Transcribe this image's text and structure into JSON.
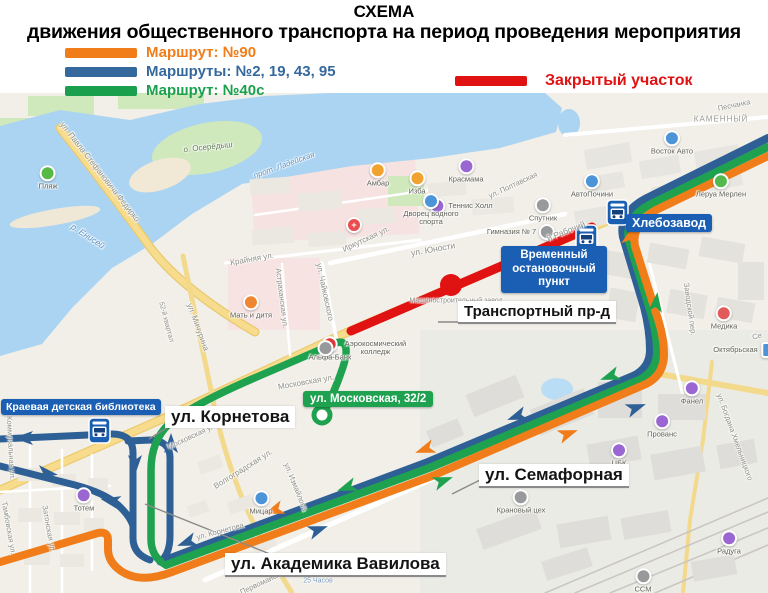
{
  "header": {
    "title": "СХЕМА",
    "subtitle": "движения общественного транспорта на период проведения мероприятия"
  },
  "legend": {
    "routes": [
      {
        "label": "Маршрут: №90",
        "color": "#f07d1a"
      },
      {
        "label": "Маршруты: №2, 19, 43, 95",
        "color": "#35689c"
      },
      {
        "label": "Маршрут: №40с",
        "color": "#1aa04c"
      }
    ],
    "closed": {
      "label": "Закрытый участок",
      "color": "#e01212"
    }
  },
  "callouts": {
    "hlebozavod": "Хлебозавод",
    "temp_stop_lines": [
      "Временный",
      "остановочный",
      "пункт"
    ],
    "library": "Краевая детская библиотека",
    "moskovskaya": "ул. Московская, 32/2",
    "transportny": "Транспортный пр-д",
    "kornetova": "ул. Корнетова",
    "semafornaya": "ул. Семафорная",
    "vavilova": "ул. Академика Вавилова"
  },
  "colors": {
    "route_90": "#f07d1a",
    "routes_2_19_43_95": "#2e6096",
    "route_40c": "#1ea24f",
    "closed_section": "#e01212",
    "water": "#abd4f2",
    "land": "#f1efe8",
    "stop_label_bg": "#1a5fb3"
  },
  "map": {
    "pois": [
      {
        "label": "Пляж",
        "x": 48,
        "y": 178,
        "color": "#58b947"
      },
      {
        "label": "Амбар",
        "x": 378,
        "y": 175,
        "color": "#f0a32e"
      },
      {
        "label": "Изба",
        "x": 417,
        "y": 183,
        "color": "#f0a32e"
      },
      {
        "label": "Красмама",
        "x": 466,
        "y": 171,
        "color": "#9a66d2"
      },
      {
        "label": "Теннис Холл",
        "x": 461,
        "y": 206,
        "color": "#9a66d2",
        "lp": "r"
      },
      {
        "label": "Дворец водного спорта",
        "x": 431,
        "y": 210,
        "color": "#4b94d8",
        "w": 66
      },
      {
        "label": "Спутник",
        "x": 543,
        "y": 210,
        "color": "#98999b"
      },
      {
        "label": "Гимназия № 7",
        "x": 521,
        "y": 232,
        "color": "#98999b",
        "lp": "l"
      },
      {
        "label": "АвтоПочини",
        "x": 592,
        "y": 186,
        "color": "#4b94d8"
      },
      {
        "label": "Восток Авто",
        "x": 672,
        "y": 143,
        "color": "#4b94d8"
      },
      {
        "label": "Леруа Мерлен",
        "x": 721,
        "y": 186,
        "color": "#52b94e"
      },
      {
        "label": "Медика",
        "x": 724,
        "y": 318,
        "color": "#e25b5b"
      },
      {
        "label": "Мать и дитя",
        "x": 251,
        "y": 307,
        "color": "#ef8632"
      },
      {
        "label": "Альфа-Банк",
        "x": 330,
        "y": 349,
        "color": "#e03636"
      },
      {
        "label": "Аэрокосмический колледж",
        "x": 366,
        "y": 348,
        "color": "#98999b",
        "lp": "r",
        "w": 78
      },
      {
        "label": "",
        "x": 354,
        "y": 225,
        "color": "#ea4d4d",
        "g": "+"
      },
      {
        "label": "Тотем",
        "x": 84,
        "y": 500,
        "color": "#9a66d2"
      },
      {
        "label": "Мицар",
        "x": 261,
        "y": 503,
        "color": "#4b94d8"
      },
      {
        "label": "Фанел",
        "x": 692,
        "y": 393,
        "color": "#9a66d2"
      },
      {
        "label": "Прованс",
        "x": 662,
        "y": 426,
        "color": "#9a66d2"
      },
      {
        "label": "ЦБК",
        "x": 619,
        "y": 455,
        "color": "#9a66d2"
      },
      {
        "label": "Радуга",
        "x": 729,
        "y": 543,
        "color": "#9a66d2"
      },
      {
        "label": "Крановый цех",
        "x": 521,
        "y": 502,
        "color": "#98999b"
      },
      {
        "label": "ССМ",
        "x": 643,
        "y": 581,
        "color": "#98999b"
      },
      {
        "label": "Октябрьская",
        "x": 745,
        "y": 350,
        "color": "#4b94d8",
        "lp": "l",
        "sq": true
      }
    ],
    "streets": [
      {
        "label": "ул. Павла Стефановича Федирко",
        "x": 100,
        "y": 172,
        "rot": 52,
        "fs": 8
      },
      {
        "label": "р. Енисей",
        "x": 88,
        "y": 236,
        "rot": 33,
        "fs": 8.5,
        "c": "#5f93c4",
        "i": true
      },
      {
        "label": "о. Осерёдыш",
        "x": 208,
        "y": 147,
        "rot": -6,
        "fs": 8,
        "c": "#5f7d52"
      },
      {
        "label": "прот. Ладейская",
        "x": 284,
        "y": 165,
        "rot": -20,
        "fs": 8,
        "c": "#5f93c4",
        "i": true
      },
      {
        "label": "Иркутская ул.",
        "x": 366,
        "y": 239,
        "rot": -25,
        "fs": 8
      },
      {
        "label": "ул. Юности",
        "x": 433,
        "y": 249,
        "rot": -10,
        "fs": 8.5
      },
      {
        "label": "Крайняя ул.",
        "x": 252,
        "y": 259,
        "rot": -10,
        "fs": 8
      },
      {
        "label": "ул. Чайковского",
        "x": 325,
        "y": 292,
        "rot": 78,
        "fs": 8
      },
      {
        "label": "Астраханская ул.",
        "x": 282,
        "y": 298,
        "rot": 83,
        "fs": 7.5
      },
      {
        "label": "ул. Мичурина",
        "x": 198,
        "y": 327,
        "rot": 70,
        "fs": 8
      },
      {
        "label": "52-й квартал",
        "x": 166,
        "y": 322,
        "rot": 75,
        "fs": 7
      },
      {
        "label": "Московская ул.",
        "x": 306,
        "y": 382,
        "rot": -10,
        "fs": 8
      },
      {
        "label": "Московская ул.",
        "x": 192,
        "y": 436,
        "rot": -25,
        "fs": 7.5
      },
      {
        "label": "Волгоградская ул.",
        "x": 243,
        "y": 469,
        "rot": -32,
        "fs": 8
      },
      {
        "label": "ул. Измайлова",
        "x": 296,
        "y": 487,
        "rot": 68,
        "fs": 7.5
      },
      {
        "label": "Коммунальная ул.",
        "x": 11,
        "y": 448,
        "rot": 87,
        "fs": 7.5
      },
      {
        "label": "Тамбовская ул.",
        "x": 9,
        "y": 528,
        "rot": 80,
        "fs": 7.5
      },
      {
        "label": "Затонская ул.",
        "x": 49,
        "y": 529,
        "rot": 80,
        "fs": 7.5
      },
      {
        "label": "ул. Корнетова",
        "x": 220,
        "y": 531,
        "rot": -15,
        "fs": 7.5
      },
      {
        "label": "Первомайская ул.",
        "x": 269,
        "y": 579,
        "rot": -25,
        "fs": 7.5
      },
      {
        "label": "25 Часов",
        "x": 318,
        "y": 581,
        "rot": 0,
        "fs": 7,
        "c": "#7d9bbf"
      },
      {
        "label": "й Рабочий",
        "x": 566,
        "y": 231,
        "rot": -22,
        "fs": 8.5
      },
      {
        "label": "Заводской пер.",
        "x": 690,
        "y": 309,
        "rot": 82,
        "fs": 7.5
      },
      {
        "label": "ул. Богдана Хмельницкого",
        "x": 735,
        "y": 437,
        "rot": 70,
        "fs": 7.5
      },
      {
        "label": "КАМЕННЫЙ",
        "x": 721,
        "y": 119,
        "rot": 0,
        "fs": 8,
        "c": "#9a9a94",
        "ls": 1
      },
      {
        "label": "Песчанка",
        "x": 734,
        "y": 105,
        "rot": -12,
        "fs": 7.5
      },
      {
        "label": "ул. Полтавская",
        "x": 513,
        "y": 185,
        "rot": -25,
        "fs": 7.5
      },
      {
        "label": "Машиностроительный завод",
        "x": 456,
        "y": 301,
        "rot": 0,
        "fs": 7
      },
      {
        "label": "Се",
        "x": 757,
        "y": 336,
        "rot": -15,
        "fs": 7.5
      }
    ],
    "arrows": [
      {
        "x": 628,
        "y": 245,
        "rot": -75,
        "color": "#f07d1a"
      },
      {
        "x": 655,
        "y": 312,
        "rot": -83,
        "color": "#1ea24f"
      },
      {
        "x": 619,
        "y": 373,
        "rot": 160,
        "color": "#1ea24f"
      },
      {
        "x": 526,
        "y": 413,
        "rot": 160,
        "color": "#2e6096"
      },
      {
        "x": 627,
        "y": 411,
        "rot": -20,
        "color": "#2e6096"
      },
      {
        "x": 559,
        "y": 437,
        "rot": -20,
        "color": "#f07d1a"
      },
      {
        "x": 434,
        "y": 446,
        "rot": 160,
        "color": "#f07d1a"
      },
      {
        "x": 434,
        "y": 484,
        "rot": -20,
        "color": "#1ea24f"
      },
      {
        "x": 356,
        "y": 484,
        "rot": 160,
        "color": "#1ea24f"
      },
      {
        "x": 283,
        "y": 507,
        "rot": 160,
        "color": "#f07d1a"
      },
      {
        "x": 196,
        "y": 539,
        "rot": 160,
        "color": "#2e6096"
      },
      {
        "x": 309,
        "y": 533,
        "rot": -20,
        "color": "#2e6096"
      },
      {
        "x": 135,
        "y": 455,
        "rot": 90,
        "color": "#2e6096"
      },
      {
        "x": 171,
        "y": 453,
        "rot": -90,
        "color": "#2e6096"
      },
      {
        "x": 33,
        "y": 438,
        "rot": 180,
        "color": "#2e6096"
      },
      {
        "x": 38,
        "y": 472,
        "rot": 8,
        "color": "#2e6096"
      },
      {
        "x": 120,
        "y": 503,
        "rot": 192,
        "color": "#2e6096"
      }
    ]
  }
}
